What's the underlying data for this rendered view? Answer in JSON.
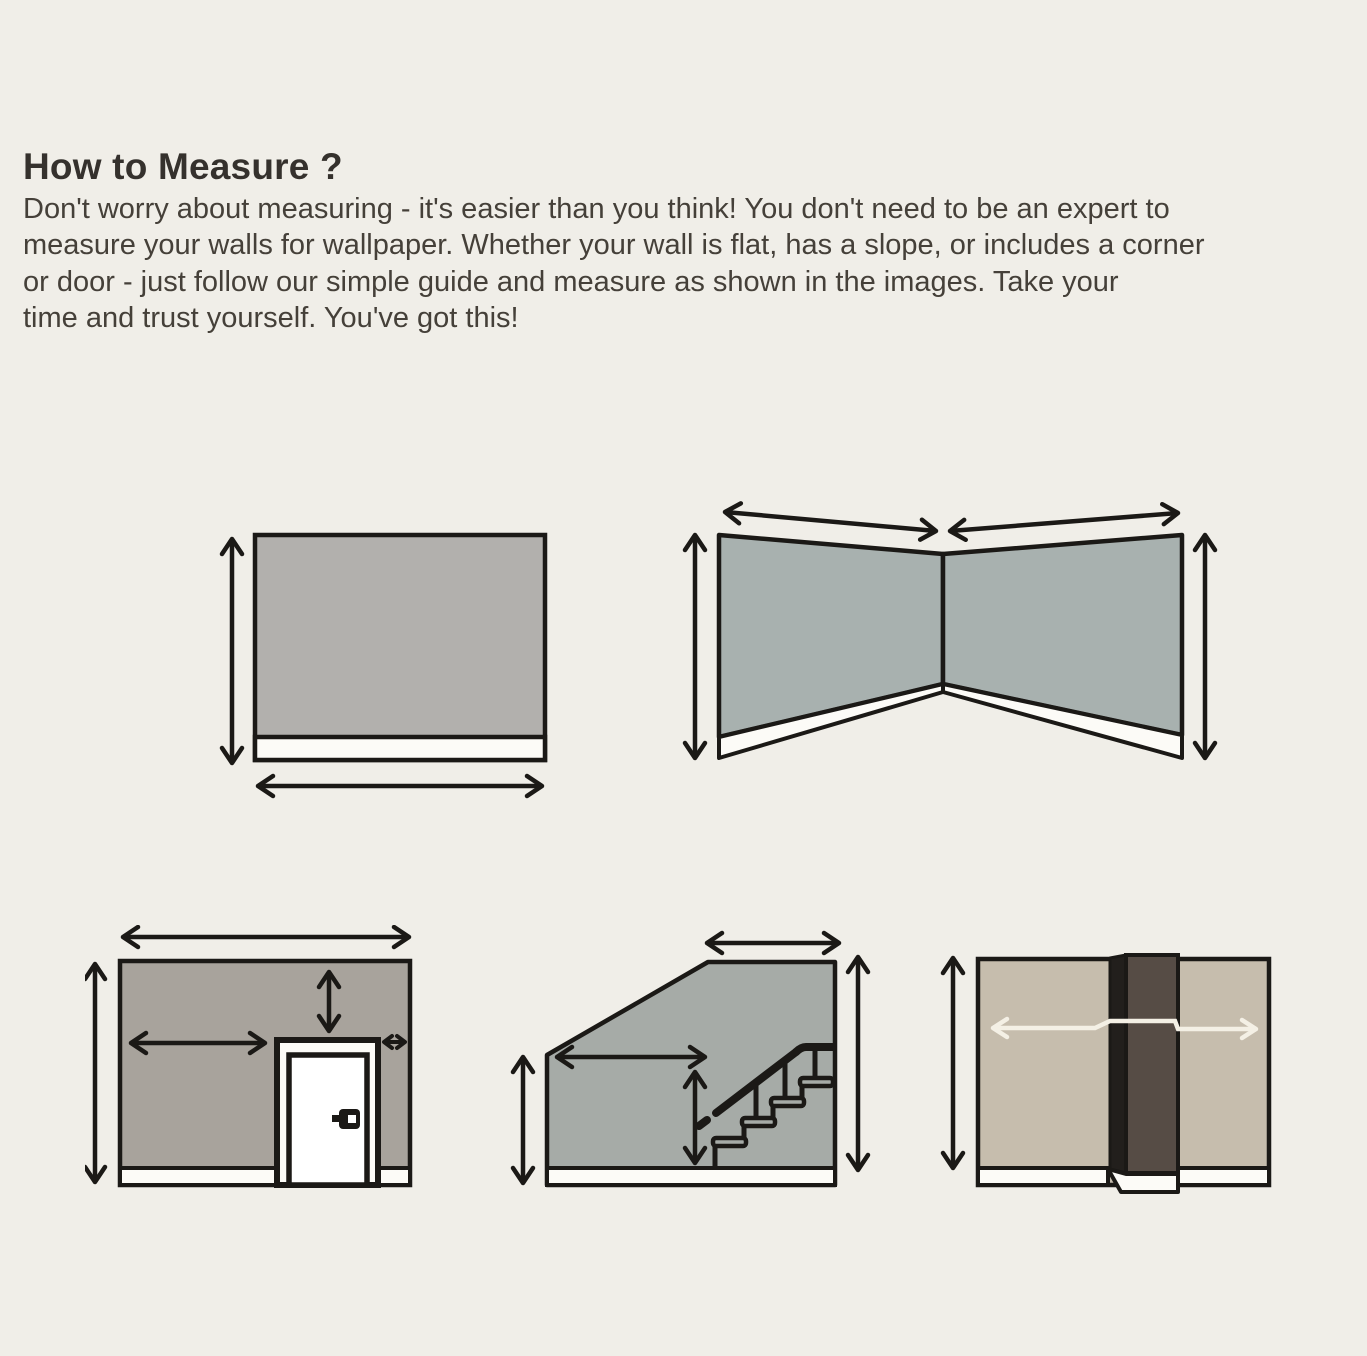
{
  "header": {
    "title": "How to Measure ?"
  },
  "intro": {
    "lines": [
      "Don't worry about measuring - it's easier than you think! You don't need to be an expert to",
      "measure your walls for wallpaper. Whether your wall is flat, has a slope, or includes a corner",
      "or door - just follow our simple guide and measure as shown in the images. Take your",
      "time and trust yourself. You've got this!"
    ]
  },
  "diagrams": [
    {
      "id": "flat-wall-diagram",
      "icon": "flat-wall-width-height-arrows-icon"
    },
    {
      "id": "corner-wall-diagram",
      "icon": "corner-two-walls-arrows-icon"
    },
    {
      "id": "wall-with-door-diagram",
      "icon": "wall-door-arrows-icon"
    },
    {
      "id": "sloped-wall-stairs-diagram",
      "icon": "sloped-wall-staircase-arrows-icon"
    },
    {
      "id": "wall-with-column-diagram",
      "icon": "wall-column-wraparound-arrow-icon"
    }
  ],
  "colors": {
    "bg": "#f0eee8",
    "ink": "#1b1916",
    "textHeading": "#35312d",
    "textBody": "#454039",
    "wallFlat": "#b2b0ad",
    "wallCorner": "#a8b1af",
    "wallDoor": "#a8a39c",
    "wallSlope": "#a6aba7",
    "wallColumn": "#c6bdad",
    "columnFront": "#564c45",
    "columnSide": "#221f1c",
    "baseboard": "#fcfbf7",
    "arrowWhite": "#f4f0e5"
  }
}
